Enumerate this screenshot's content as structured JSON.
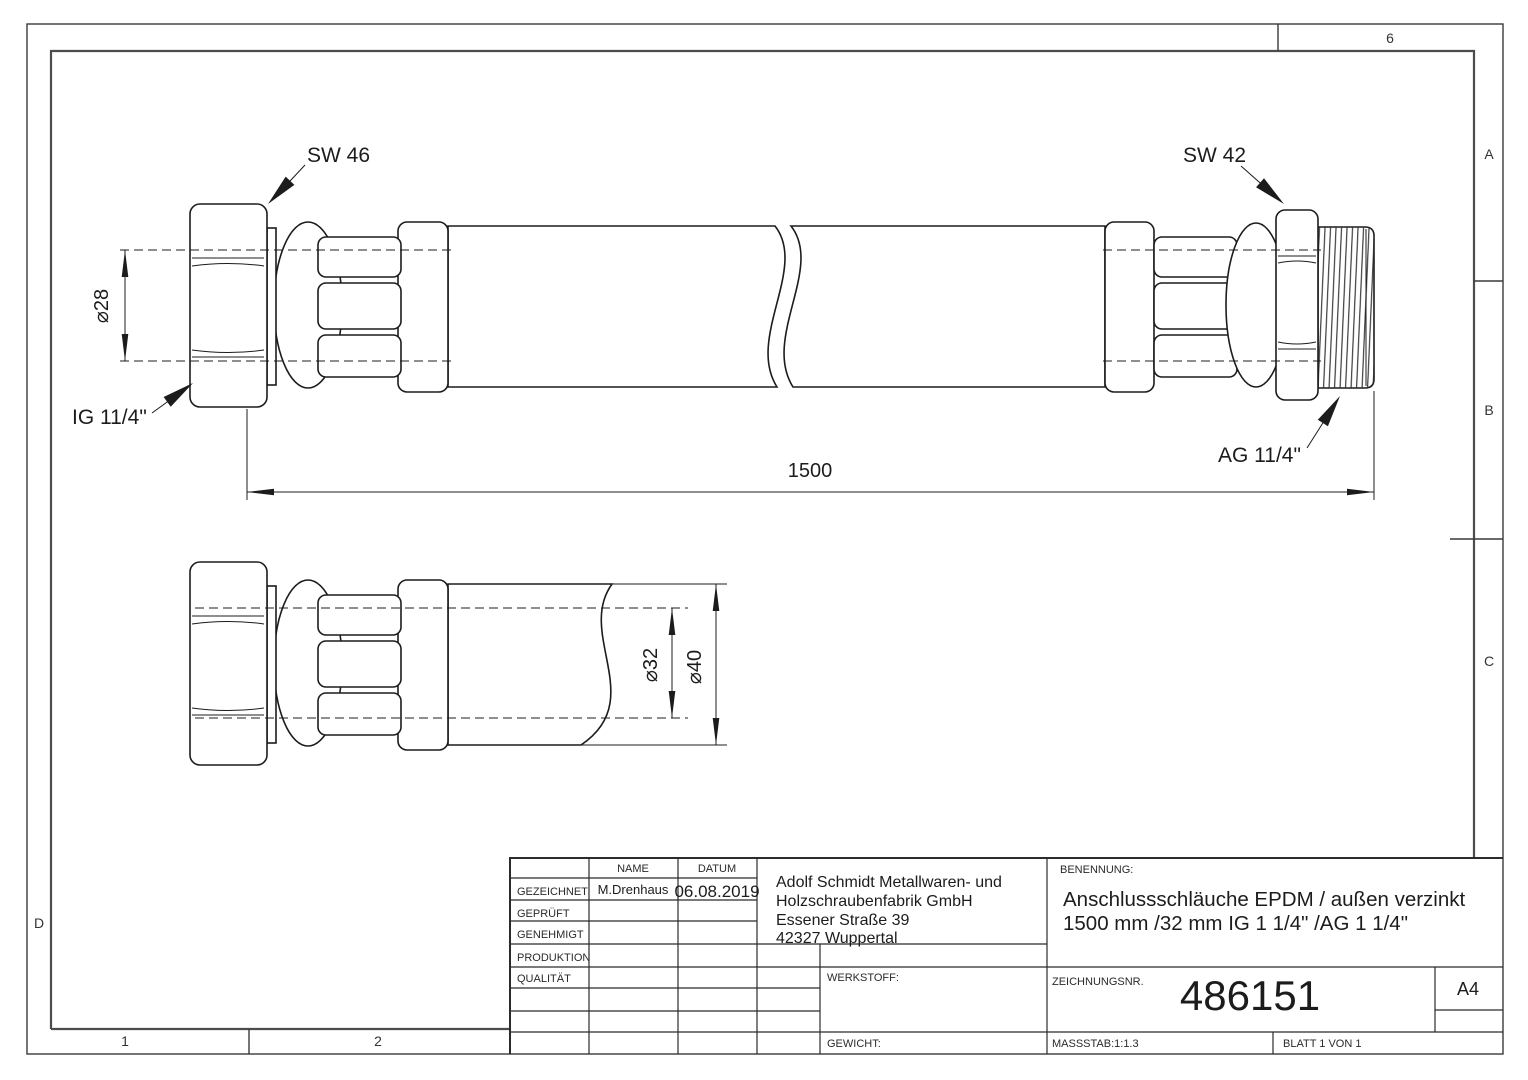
{
  "sheet": {
    "zones": {
      "col6": "6",
      "rowA": "A",
      "rowB": "B",
      "rowC": "C",
      "rowD": "D",
      "col1": "1",
      "col2": "2"
    }
  },
  "annotations": {
    "sw_left": "SW 46",
    "sw_right": "SW 42",
    "ig_thread": "IG 11/4\"",
    "ag_thread": "AG 11/4\"",
    "dia_nut": "⌀28",
    "hose_length": "1500",
    "dia_inner": "⌀32",
    "dia_outer": "⌀40"
  },
  "titleblock": {
    "name_header": "NAME",
    "date_header": "DATUM",
    "rows": [
      {
        "label": "GEZEICHNET",
        "name": "M.Drenhaus",
        "date": "06.08.2019"
      },
      {
        "label": "GEPRÜFT"
      },
      {
        "label": "GENEHMIGT"
      },
      {
        "label": "PRODUKTION"
      },
      {
        "label": "QUALITÄT"
      }
    ],
    "company": [
      "Adolf Schmidt Metallwaren- und",
      "Holzschraubenfabrik GmbH",
      "Essener Straße 39",
      "42327 Wuppertal"
    ],
    "benennung_label": "BENENNUNG:",
    "title_lines": [
      "Anschlussschläuche EPDM / außen verzinkt",
      "1500 mm /32 mm IG 1 1/4\" /AG 1 1/4\""
    ],
    "werkstoff_label": "WERKSTOFF:",
    "gewicht_label": "GEWICHT:",
    "drawing_no_label": "ZEICHNUNGSNR.",
    "drawing_no": "486151",
    "paper_format": "A4",
    "scale": "MASSSTAB:1:1.3",
    "sheet_label": "BLATT 1 VON 1"
  }
}
